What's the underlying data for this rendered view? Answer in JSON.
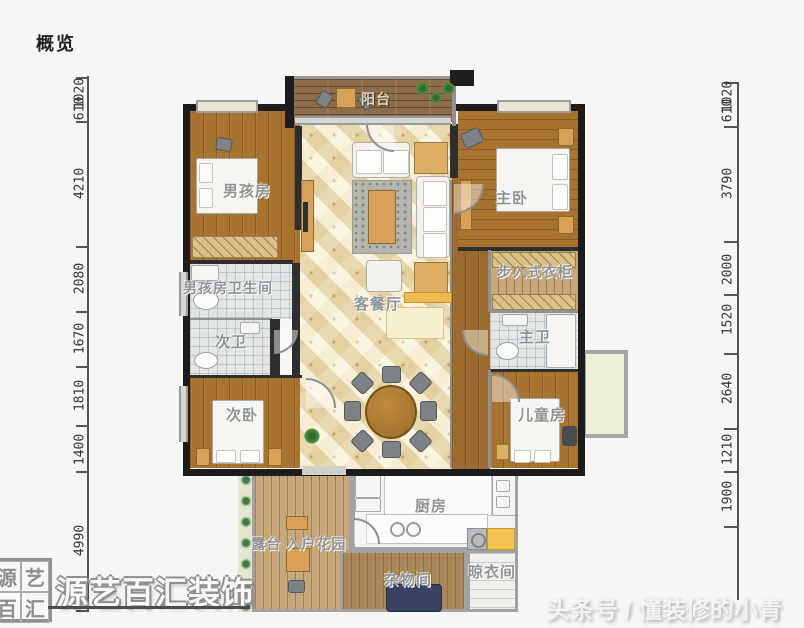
{
  "title": "概览",
  "watermark": {
    "seal_chars": [
      "源",
      "艺",
      "百",
      "汇"
    ],
    "brand": "源艺百汇装饰",
    "credit": "头条号 / 懂装修的小青"
  },
  "rooms": {
    "balcony": "阳台",
    "boys_room": "男孩房",
    "master_bedroom": "主卧",
    "boys_bathroom": "男孩房卫生间",
    "walk_in_closet": "步入式衣柜",
    "living_dining": "客餐厅",
    "second_bathroom": "次卫",
    "master_bathroom": "主卫",
    "second_bedroom": "次卧",
    "kids_room": "儿童房",
    "kitchen": "厨房",
    "terrace_garden": "露台 入户花园",
    "storage_room": "杂物间",
    "drying_room": "晾衣间"
  },
  "dimensions": {
    "left": [
      "1020",
      "610",
      "4210",
      "2080",
      "1670",
      "1810",
      "1400",
      "4990"
    ],
    "right": [
      "1020",
      "610",
      "3790",
      "2000",
      "1520",
      "2640",
      "1210",
      "1900"
    ]
  },
  "colors": {
    "wall": "#1c1c1c",
    "wood_floor": "#a8722f",
    "tile_floor": "#e2e5e5",
    "living_tile": "#efe3bc",
    "accent_yellow": "#f3c24f"
  }
}
